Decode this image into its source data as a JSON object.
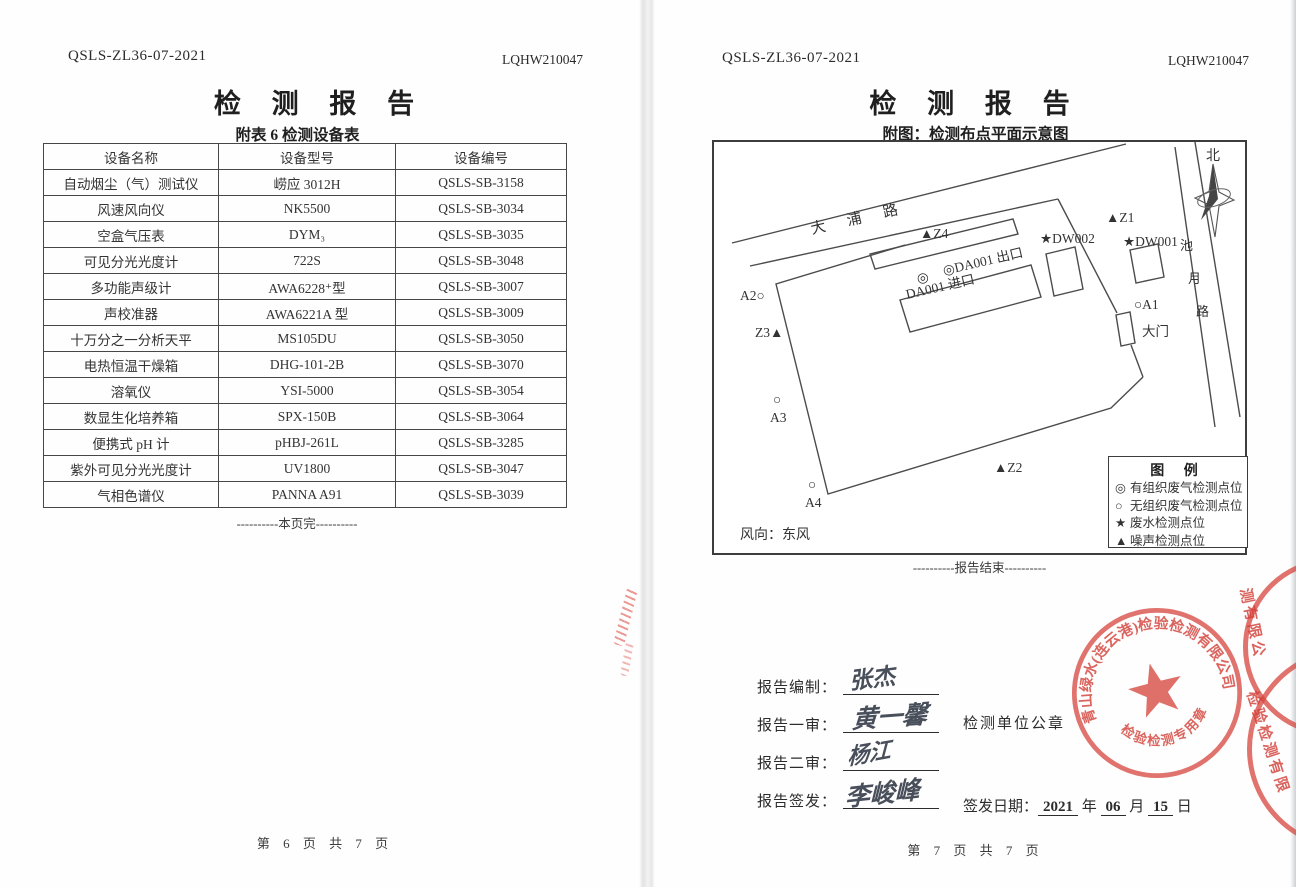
{
  "left_page": {
    "doc_code": "QSLS-ZL36-07-2021",
    "report_no": "LQHW210047",
    "title": "检 测 报 告",
    "subtitle": "附表 6  检测设备表",
    "table": {
      "headers": [
        "设备名称",
        "设备型号",
        "设备编号"
      ],
      "rows": [
        [
          "自动烟尘（气）测试仪",
          "崂应 3012H",
          "QSLS-SB-3158"
        ],
        [
          "风速风向仪",
          "NK5500",
          "QSLS-SB-3034"
        ],
        [
          "空盒气压表",
          "DYM₃",
          "QSLS-SB-3035"
        ],
        [
          "可见分光光度计",
          "722S",
          "QSLS-SB-3048"
        ],
        [
          "多功能声级计",
          "AWA6228⁺型",
          "QSLS-SB-3007"
        ],
        [
          "声校准器",
          "AWA6221A 型",
          "QSLS-SB-3009"
        ],
        [
          "十万分之一分析天平",
          "MS105DU",
          "QSLS-SB-3050"
        ],
        [
          "电热恒温干燥箱",
          "DHG-101-2B",
          "QSLS-SB-3070"
        ],
        [
          "溶氧仪",
          "YSI-5000",
          "QSLS-SB-3054"
        ],
        [
          "数显生化培养箱",
          "SPX-150B",
          "QSLS-SB-3064"
        ],
        [
          "便携式 pH 计",
          "pHBJ-261L",
          "QSLS-SB-3285"
        ],
        [
          "紫外可见分光光度计",
          "UV1800",
          "QSLS-SB-3047"
        ],
        [
          "气相色谱仪",
          "PANNA A91",
          "QSLS-SB-3039"
        ]
      ]
    },
    "end_note": "----------本页完----------",
    "footer": "第 6 页 共 7 页"
  },
  "right_page": {
    "doc_code": "QSLS-ZL36-07-2021",
    "report_no": "LQHW210047",
    "title": "检 测 报 告",
    "subtitle": "附图：检测布点平面示意图",
    "diagram": {
      "north_label": "北",
      "road_dapu": "大浦路",
      "road_chiyue": "池月路",
      "wind_note": "风向：东风",
      "markers": [
        {
          "t": "▲Z4",
          "x": 206,
          "y": 96
        },
        {
          "t": "▲Z1",
          "x": 392,
          "y": 80
        },
        {
          "t": "★DW002",
          "x": 326,
          "y": 101
        },
        {
          "t": "★DW001",
          "x": 409,
          "y": 104
        },
        {
          "t": "◎",
          "x": 203,
          "y": 140
        },
        {
          "t": "◎DA001 出口",
          "x": 230,
          "y": 133,
          "r": -13
        },
        {
          "t": "DA001 进口",
          "x": 193,
          "y": 157,
          "r": -13
        },
        {
          "t": "A2○",
          "x": 26,
          "y": 158
        },
        {
          "t": "Z3▲",
          "x": 41,
          "y": 195
        },
        {
          "t": "○",
          "x": 59,
          "y": 262
        },
        {
          "t": "A3",
          "x": 56,
          "y": 280
        },
        {
          "t": "○",
          "x": 94,
          "y": 347
        },
        {
          "t": "A4",
          "x": 91,
          "y": 365
        },
        {
          "t": "▲Z2",
          "x": 280,
          "y": 330
        },
        {
          "t": "○A1",
          "x": 420,
          "y": 167
        },
        {
          "t": "大门",
          "x": 428,
          "y": 194
        }
      ],
      "legend": {
        "title": "图  例",
        "items": [
          {
            "sym": "◎",
            "label": "有组织废气检测点位"
          },
          {
            "sym": "○",
            "label": "无组织废气检测点位"
          },
          {
            "sym": "★",
            "label": "废水检测点位"
          },
          {
            "sym": "▲",
            "label": "噪声检测点位"
          }
        ]
      }
    },
    "end_note": "----------报告结束----------",
    "signatures": [
      {
        "label": "报告编制：",
        "name": "张杰"
      },
      {
        "label": "报告一审：",
        "name": "黄一馨"
      },
      {
        "label": "报告二审：",
        "name": "杨江"
      },
      {
        "label": "报告签发：",
        "name": "李峻峰"
      }
    ],
    "seal_caption": "检测单位公章",
    "stamp": {
      "company": "青山绿水(连云港)检验检测有限公司",
      "type_text": "检验检测专用章"
    },
    "edge_stamp_fragments": [
      "测有限公",
      "检验检测有限"
    ],
    "issue_date": {
      "label": "签发日期：",
      "year": "2021",
      "y_unit": "年",
      "month": "06",
      "m_unit": "月",
      "day": "15",
      "d_unit": "日"
    },
    "footer": "第 7 页 共 7 页"
  }
}
